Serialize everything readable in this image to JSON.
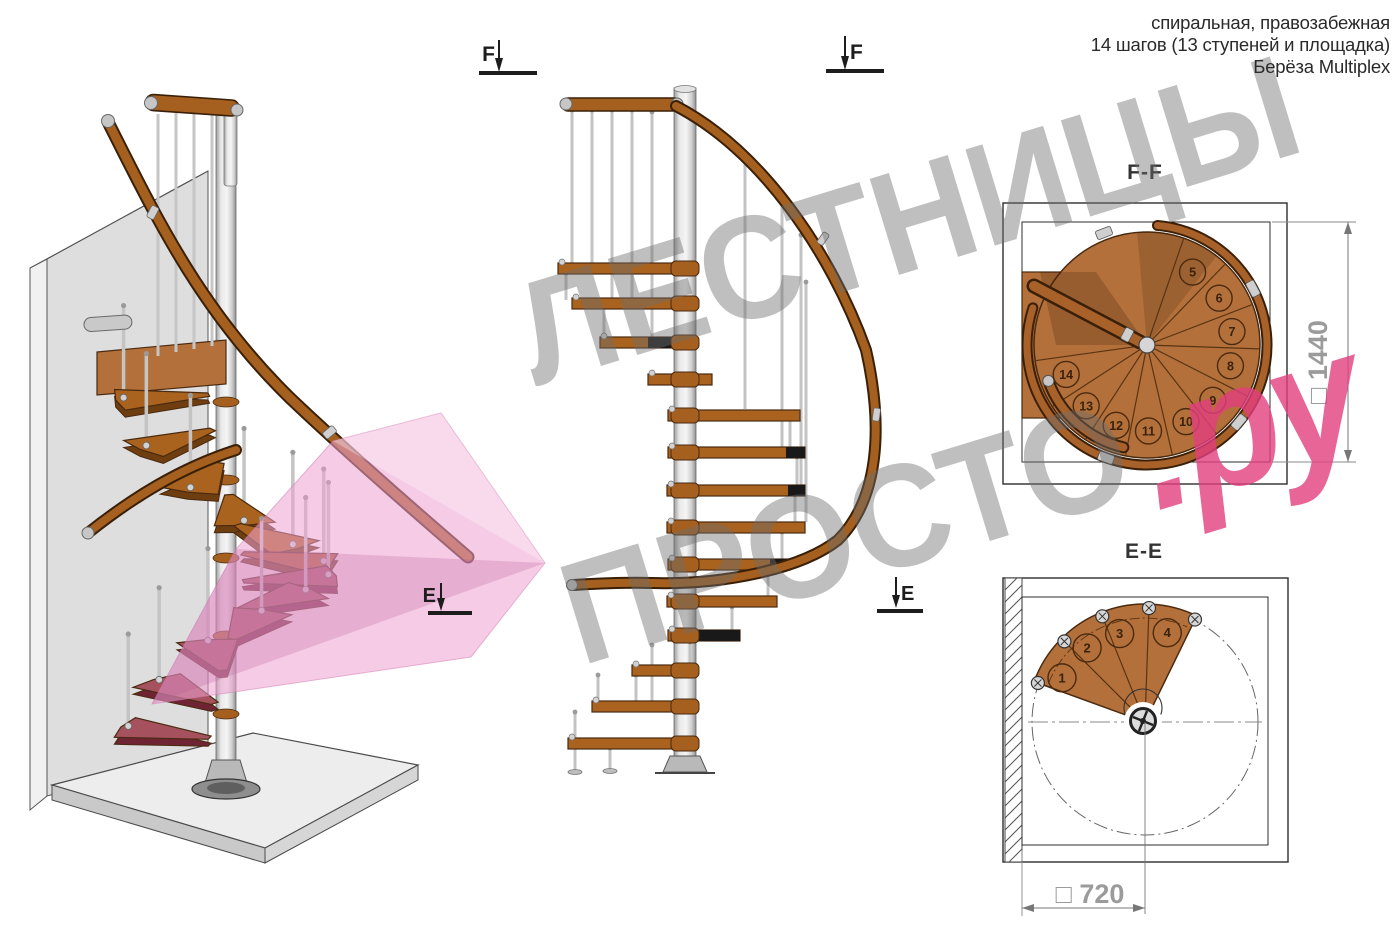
{
  "header": {
    "line1": "спиральная, правозабежная",
    "line2": "14 шагов (13 ступеней и площадка)",
    "line3": "Берёза Multiplex"
  },
  "watermark": {
    "line1": "ЛЕСТНИЦЫ",
    "line2": "ПРОСТО",
    "suffix": ".ру"
  },
  "sections": {
    "ff": {
      "title": "F-F",
      "dimension": "□ 1440",
      "step_numbers": [
        "5",
        "6",
        "7",
        "8",
        "9",
        "10",
        "11",
        "12",
        "13",
        "14"
      ]
    },
    "ee": {
      "title": "E-E",
      "dimension": "□ 720",
      "step_numbers": [
        "1",
        "2",
        "3",
        "4"
      ]
    }
  },
  "markers": {
    "f": "F",
    "e": "E"
  },
  "colors": {
    "wood": "#b3703a",
    "wood_dark": "#8a5220",
    "wood_outline": "#4a2a10",
    "rail_wood": "#a5601f",
    "rail_outline": "#3a2008",
    "metal": "#c6c6c6",
    "metal_dark": "#777777",
    "pink_plane": "#eea0d0",
    "pink_step": "#a5525e",
    "watermark_gray": "#6e6e6e",
    "watermark_pink": "#e23f7e",
    "drawing_line": "#2e2e2e",
    "dim_gray": "#9b9b9b"
  }
}
